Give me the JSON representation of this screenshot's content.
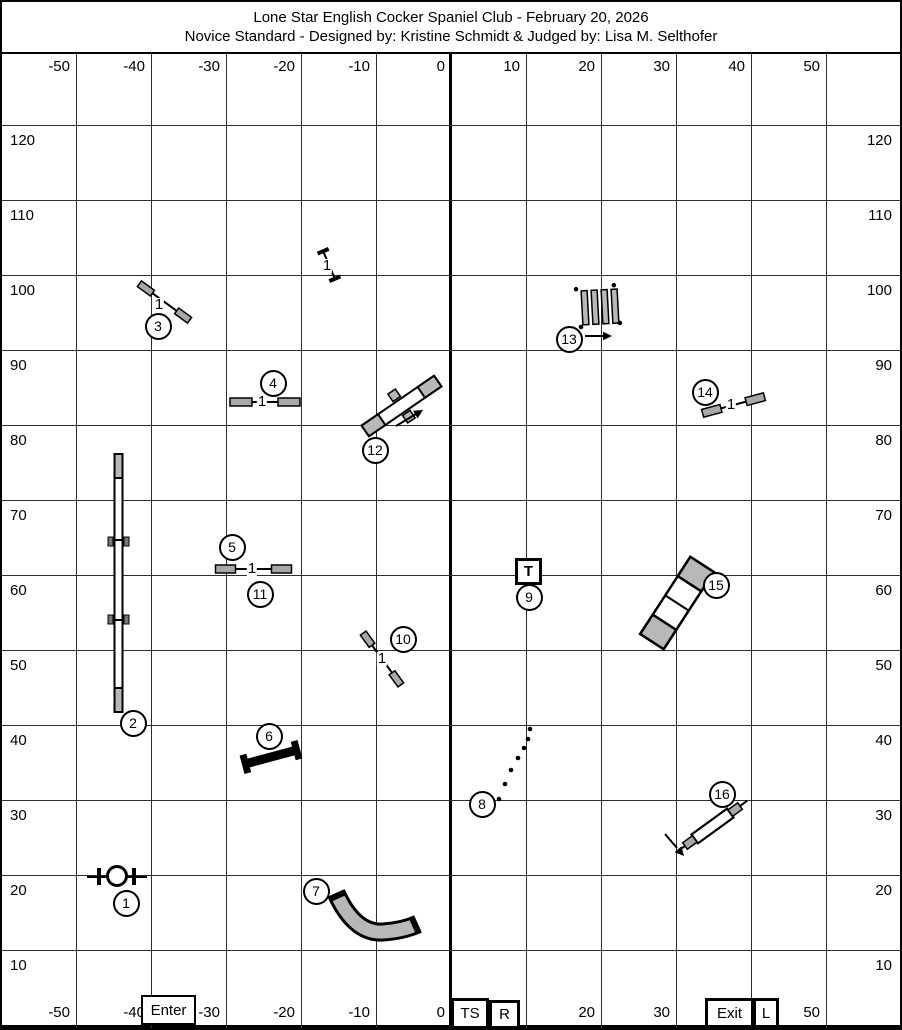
{
  "title": {
    "line1": "Lone Star English Cocker Spaniel Club - February 20, 2026",
    "line2": "Novice Standard - Designed by: Kristine Schmidt & Judged by: Lisa M. Selthofer"
  },
  "axis": {
    "x_labels": [
      "-50",
      "-40",
      "-30",
      "-20",
      "-10",
      "0",
      "10",
      "20",
      "30",
      "40",
      "50"
    ],
    "y_labels": [
      "120",
      "110",
      "100",
      "90",
      "80",
      "70",
      "60",
      "50",
      "40",
      "30",
      "20",
      "10"
    ]
  },
  "markers": {
    "enter": "Enter",
    "timer_start": "TS",
    "right": "R",
    "exit": "Exit",
    "left": "L"
  },
  "obstacles": [
    {
      "num": "1",
      "type": "tire-jump"
    },
    {
      "num": "2",
      "type": "dog-walk"
    },
    {
      "num": "3",
      "type": "winged-jump",
      "bars": "1"
    },
    {
      "num": "4",
      "type": "winged-jump",
      "bars": "1"
    },
    {
      "num": "5",
      "type": "winged-jump",
      "bars": "1"
    },
    {
      "num": "6",
      "type": "wall-jump"
    },
    {
      "num": "7",
      "type": "curved-tunnel"
    },
    {
      "num": "8",
      "type": "weave-poles"
    },
    {
      "num": "9",
      "type": "table",
      "label": "T"
    },
    {
      "num": "10",
      "type": "winged-jump",
      "bars": "1"
    },
    {
      "num": "11",
      "type": "winged-jump",
      "bars": "1"
    },
    {
      "num": "12",
      "type": "teeter"
    },
    {
      "num": "13",
      "type": "broad-jump"
    },
    {
      "num": "14",
      "type": "winged-jump",
      "bars": "1"
    },
    {
      "num": "15",
      "type": "straight-tunnel"
    },
    {
      "num": "16",
      "type": "double-jump"
    },
    {
      "num": "",
      "type": "spare-jump",
      "bars": "1"
    }
  ],
  "colors": {
    "equipment_gray": "#b8b8b8",
    "wing_gray": "#a8a8a8",
    "ink": "#000000"
  }
}
